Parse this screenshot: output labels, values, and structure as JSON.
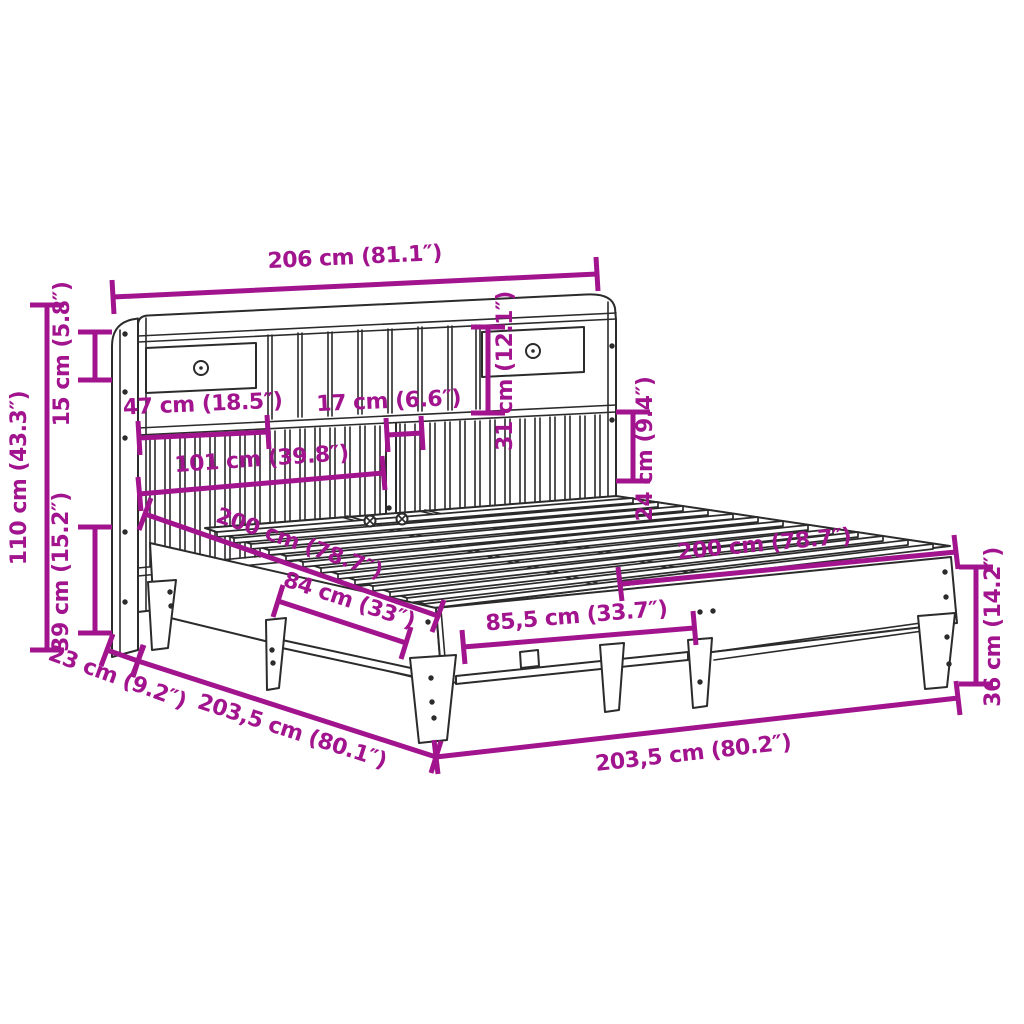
{
  "diagram": {
    "subject": "bed frame with bookcase headboard",
    "style": "technical line drawing with dimension annotations",
    "background": "#ffffff",
    "line_color": "#2b2b2b",
    "dimension_color": "#A1148E"
  },
  "dimensions": {
    "overall_width": "206 cm (81.1″)",
    "top_shelf_height": "15 cm (5.8″)",
    "headboard_total_height": "110 cm (43.3″)",
    "base_height_left": "39 cm (15.2″)",
    "left_shelf_width": "47 cm (18.5″)",
    "cubby_width": "17 cm (6.6″)",
    "lower_shelf_width": "101 cm (39.8″)",
    "upper_opening_height": "31 cm (12.1″)",
    "lower_opening_height": "24 cm (9.4″)",
    "bed_length_side": "200 cm (78.7″)",
    "bed_width_far": "200 cm (78.7″)",
    "side_leg_spacing": "84 cm (33″)",
    "front_leg_spacing": "85,5 cm (33.7″)",
    "headboard_depth": "23 cm (9.2″)",
    "floor_length": "203,5 cm (80.1″)",
    "floor_width": "203,5 cm (80.2″)",
    "frame_height_right": "36 cm (14.2″)"
  }
}
